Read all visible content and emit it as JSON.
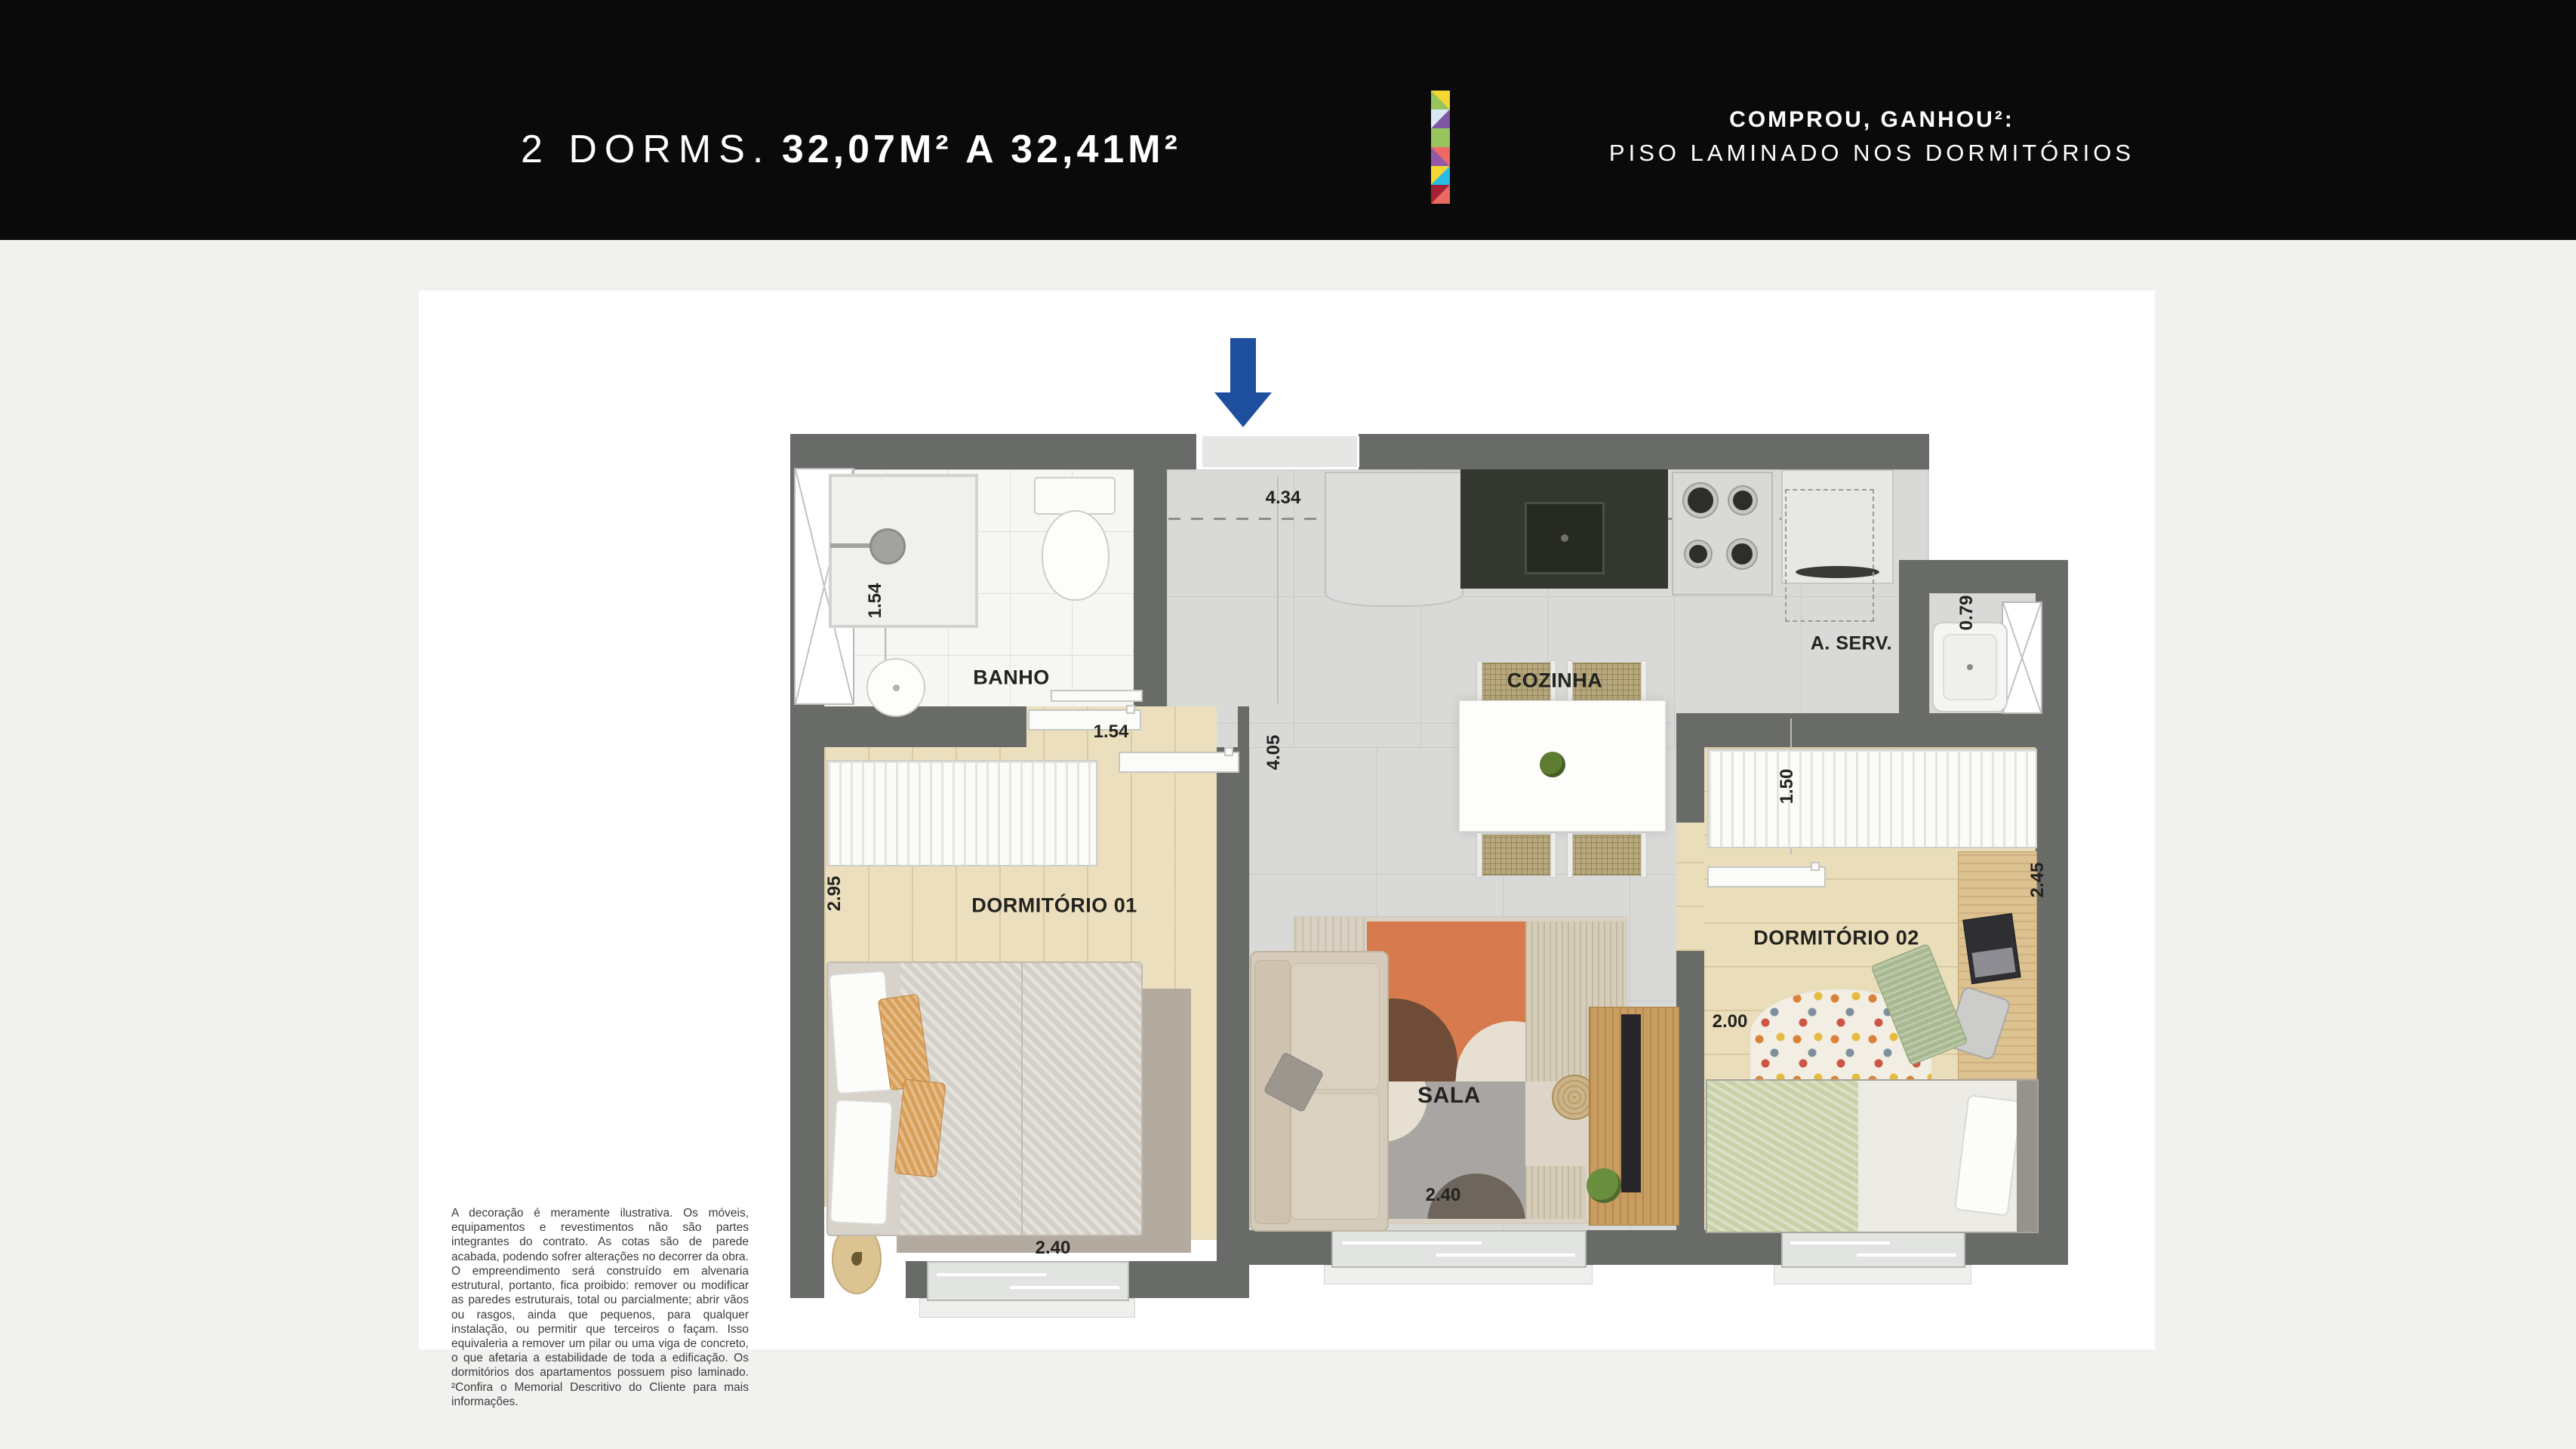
{
  "header": {
    "title_light": "2 DORMS.",
    "title_bold": "32,07M² A 32,41M²",
    "promo_line1": "COMPROU, GANHOU²:",
    "promo_line2": "PISO LAMINADO NOS DORMITÓRIOS",
    "background": "#0a0a0a",
    "logo_squares": [
      {
        "a": "#97c45c",
        "b": "#f5d733",
        "dir": "to top right"
      },
      {
        "a": "#d8e9f4",
        "b": "#7e57a5",
        "dir": "to bottom right"
      },
      {
        "a": "#97c45c"
      },
      {
        "a": "#9159a8",
        "b": "#ec6a65",
        "dir": "to top right"
      },
      {
        "a": "#f5d733",
        "b": "#27bde4",
        "dir": "to bottom right"
      },
      {
        "a": "#a32035",
        "b": "#e96a5e",
        "dir": "to bottom right"
      }
    ]
  },
  "plan": {
    "entrance_arrow_color": "#1e4f9f",
    "wall_color": "#696b69",
    "labels": {
      "banho": "BANHO",
      "cozinha": "COZINHA",
      "aserv": "A. SERV.",
      "dorm1": "DORMITÓRIO 01",
      "dorm2": "DORMITÓRIO 02",
      "sala": "SALA"
    },
    "dims": {
      "top_width": "4.34",
      "banho_left": "1.54",
      "banho_bottom": "1.54",
      "dorm1_left": "2.95",
      "hall": "4.05",
      "aserv": "1.50",
      "tanque": "0.79",
      "dorm2_right": "2.45",
      "dorm2_left": "2.00",
      "dorm1_bottom": "2.40",
      "sala_bottom": "2.40"
    }
  },
  "disclaimer": "A decoração é meramente ilustrativa. Os móveis, equipamentos e revestimentos não são partes integrantes do contrato. As cotas são de parede acabada, podendo sofrer alterações no decorrer da obra. O empreendimento será construído em alvenaria estrutural, portanto, fica proibido: remover ou modificar as paredes estruturais, total ou parcialmente; abrir vãos ou rasgos, ainda que pequenos, para qualquer instalação, ou permitir que terceiros o façam. Isso equivaleria a remover um pilar ou uma viga de concreto, o que afetaria a estabilidade de toda a edificação. Os dormitórios dos apartamentos possuem piso laminado. ²Confira o Memorial Descritivo do Cliente para mais informações."
}
